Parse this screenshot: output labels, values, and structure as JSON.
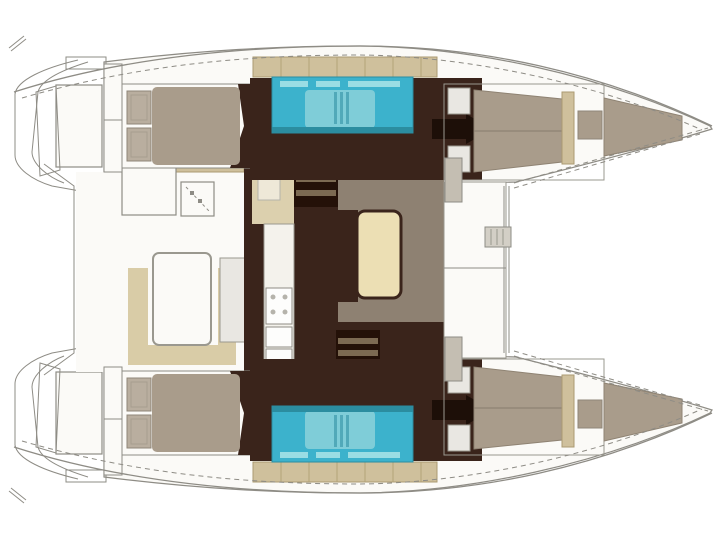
{
  "diagram": {
    "type": "boat-floorplan",
    "subject": "catamaran deck and accommodation layout, top view, bows to the right",
    "visible_text": "",
    "regions": [
      {
        "name": "stern-platforms",
        "fill": "deck_white"
      },
      {
        "name": "aft-cockpit",
        "fill": "deck_white"
      },
      {
        "name": "cockpit-table",
        "fill": "deck_white"
      },
      {
        "name": "cockpit-bench",
        "fill": "beige_bench"
      },
      {
        "name": "salon-floor",
        "fill": "dark_wood"
      },
      {
        "name": "galley",
        "fill": "appliance_white"
      },
      {
        "name": "dining-table",
        "fill": "cream_table"
      },
      {
        "name": "dining-settee",
        "fill": "taupe_settee"
      },
      {
        "name": "companionway-steps",
        "fill": "steps_dark"
      },
      {
        "name": "hull-bathroom-wet-room",
        "fill": "cyan"
      },
      {
        "name": "cabin-berth-mattress",
        "fill": "mattress"
      },
      {
        "name": "berth-pillows",
        "fill": "pillow"
      },
      {
        "name": "coachroof-cushion-strip",
        "fill": "tan"
      },
      {
        "name": "foredeck",
        "fill": "deck_white"
      },
      {
        "name": "anchor-windlass",
        "fill": "windlass_gray"
      },
      {
        "name": "trampoline",
        "fill": "bg"
      },
      {
        "name": "forepeak-berth",
        "fill": "mattress"
      }
    ]
  },
  "colors": {
    "bg": "#ffffff",
    "deck_white": "#fbfaf7",
    "line_gray": "#8e8c85",
    "line_light": "#b5b3ab",
    "dark_wood": "#3a241b",
    "steps_dark": "#241108",
    "steps_bar": "#7c6a52",
    "tan": "#cfc09c",
    "tan_border": "#ab9a72",
    "tan_light": "#dcd0ae",
    "beige_bench": "#d9cca7",
    "cream_table": "#ecdfb4",
    "taupe_settee": "#8e8172",
    "mattress": "#a99c8b",
    "mattress_line": "#8f8373",
    "pillow": "#b9ae9f",
    "pillow_border": "#8f8678",
    "cyan": "#3cb2cc",
    "cyan_light": "#7fcdd8",
    "cyan_pale": "#9adde4",
    "cyan_dark": "#2b8da0",
    "appliance_white": "#f4f2ec",
    "unit_gray": "#e9e7e2",
    "seat_gray": "#c4beb2",
    "windlass_gray": "#d3cfc6",
    "black_arrow": "#1d0f08",
    "cream_panel": "#eee8d8"
  }
}
